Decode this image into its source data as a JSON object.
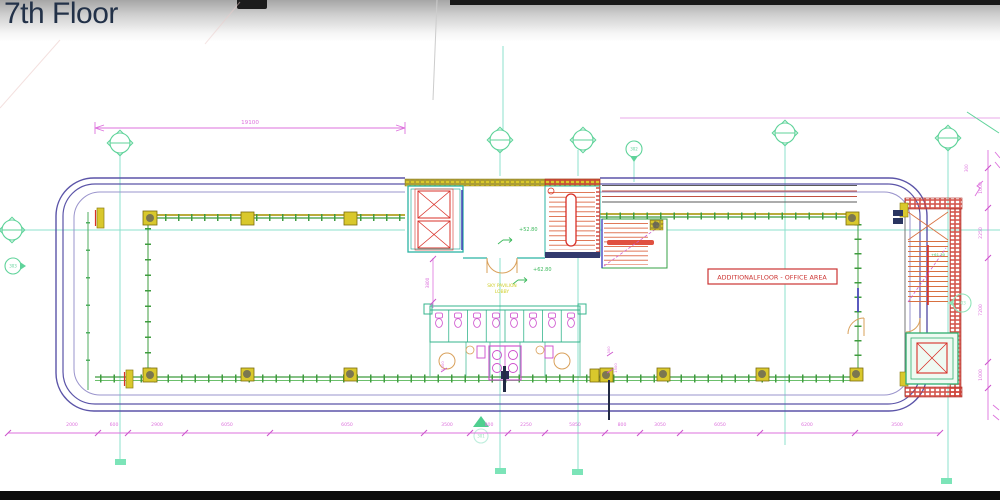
{
  "header": {
    "title": "7th Floor"
  },
  "plan": {
    "office_label": "ADDITIONALFLOOR - OFFICE AREA",
    "level_upper": "+52.80",
    "level_lower": "+62.80",
    "level_stair": "+61.30",
    "pavilion_line1": "SKY PAVILION",
    "pavilion_line2": "LOBBY",
    "dim_top": "19100",
    "dim_core": "3800",
    "dim_wc_a": "300",
    "dim_wc_b": "1500",
    "dim_wc_c": "1500",
    "dim_right_small": "300",
    "dims_bottom": [
      "2000",
      "600",
      "2900",
      "6050",
      "6050",
      "3500",
      "800",
      "2250",
      "5850",
      "800",
      "3050",
      "6050",
      "6200",
      "3500"
    ],
    "dims_right": [
      "1000",
      "2250",
      "7200",
      "1000"
    ],
    "marker_top": "302",
    "marker_left": "303",
    "marker_bottom": "301",
    "marker_stair": "303"
  }
}
